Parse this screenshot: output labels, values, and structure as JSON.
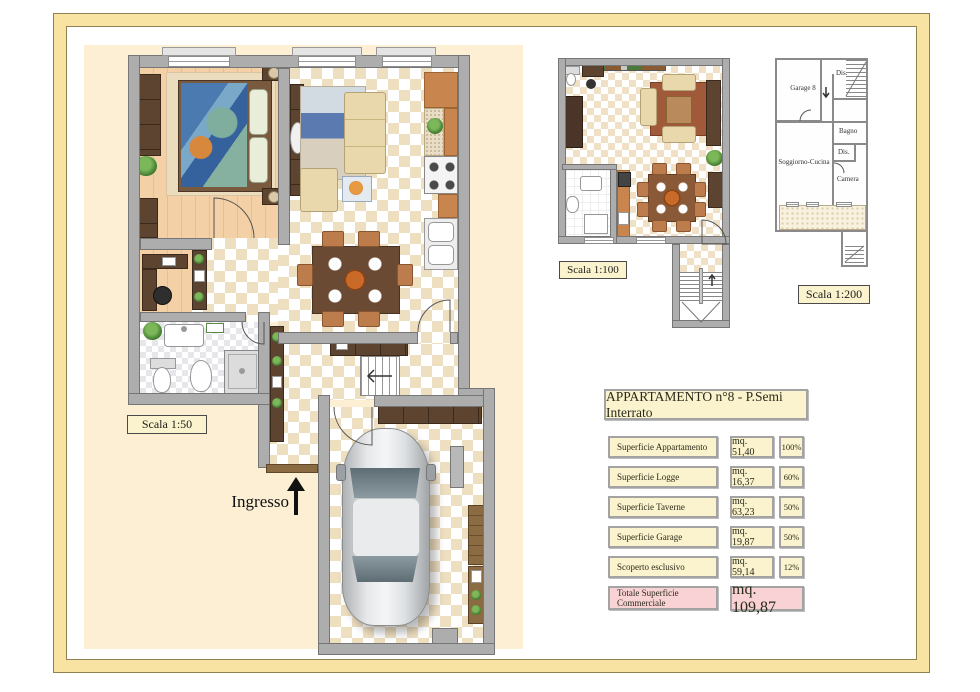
{
  "plan50": {
    "scale_label": "Scala 1:50",
    "entrance_label": "Ingresso"
  },
  "plan100": {
    "scale_label": "Scala 1:100"
  },
  "plan200": {
    "scale_label": "Scala 1:200",
    "rooms": [
      "Garage 8",
      "Dis.",
      "Bagno",
      "Dis.",
      "Soggiorno-Cucina",
      "Camera"
    ]
  },
  "table": {
    "title": "APPARTAMENTO n°8 - P.Semi Interrato",
    "rows": [
      {
        "label": "Superficie Appartamento",
        "value": "mq. 51,40",
        "pct": "100%"
      },
      {
        "label": "Superficie Logge",
        "value": "mq. 16,37",
        "pct": "60%"
      },
      {
        "label": "Superficie Taverne",
        "value": "mq. 63,23",
        "pct": "50%"
      },
      {
        "label": "Superficie Garage",
        "value": "mq. 19,87",
        "pct": "50%"
      },
      {
        "label": "Scoperto esclusivo",
        "value": "mq. 59,14",
        "pct": "12%"
      }
    ],
    "total": {
      "label": "Totale Superficie Commerciale",
      "value": "mq. 109,87"
    }
  },
  "icons": {
    "entrance_arrow": "up-arrow",
    "stair_direction_arrow": "down-arrow"
  },
  "colors": {
    "frame_gold": "#F9E3A2",
    "plan_backdrop": "#FCEFD3",
    "wall_gray": "#ADADAD",
    "table_cream": "#FBF3CD",
    "table_pink": "#F9D2D5"
  }
}
